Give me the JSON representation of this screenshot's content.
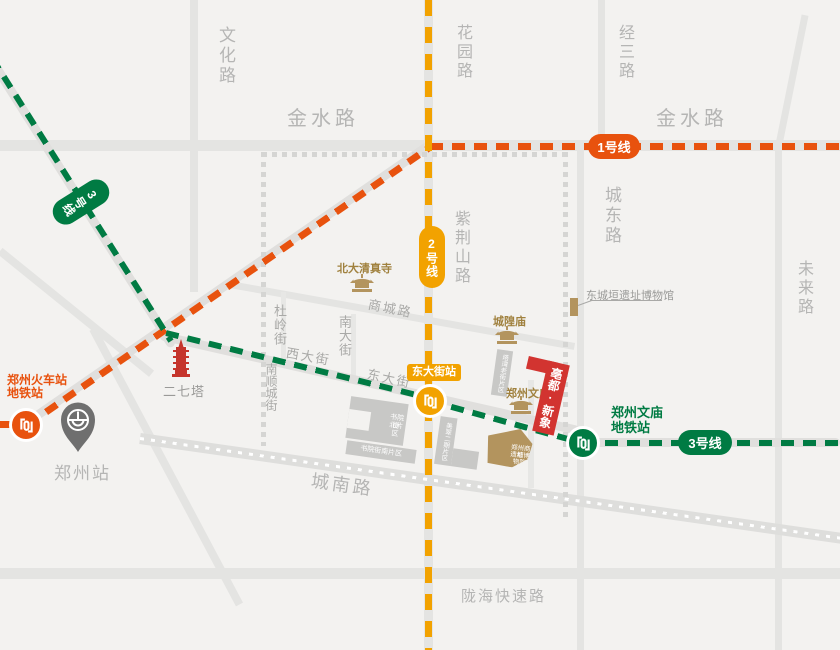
{
  "colors": {
    "line1": "#e8520e",
    "line2": "#f2a200",
    "line3": "#007b43",
    "gold": "#b3945e",
    "goldtext": "#a0813e",
    "red": "#d23430",
    "tower": "#c5352c",
    "pin": "#6f6f6f"
  },
  "roads": {
    "jinshui": "金水路",
    "wenhua": "文化路",
    "huayuan": "花园路",
    "jingsan": "经三路",
    "chengdong": "城东路",
    "weilai": "未来路",
    "zijinshan": "紫荆山路",
    "shangcheng": "商城路",
    "duling": "杜岭街",
    "nandajie": "南大街",
    "xidajie": "西大街",
    "dongdajie": "东大街",
    "nanshuncheng": "南顺城街",
    "chengnan": "城南路",
    "longhai": "陇海快速路"
  },
  "metro": {
    "line1": "1号线",
    "line2": "2号线",
    "line3": "3号线"
  },
  "stations": {
    "railway_metro_line1": "郑州火车站",
    "railway_metro_line2": "地铁站",
    "zhengzhou_station": "郑州站",
    "dongdajie_station": "东大街站",
    "wenmiao_line1": "郑州文庙",
    "wenmiao_line2": "地铁站"
  },
  "landmarks": {
    "erqi_tower": "二七塔",
    "beida_mosque": "北大清真寺",
    "chenghuang_temple": "城隍庙",
    "wenmiao": "郑州文庙",
    "dongchengyuan_museum": "东城垣遗址博物馆",
    "bodu_xinxiang": "亳都·新象",
    "shangdu_museum_line1": "郑州商都",
    "shangdu_museum_line2": "遗址博物院"
  },
  "blocks": {
    "shuyuan_north_line1": "书院街",
    "shuyuan_north_line2": "北片区",
    "shuyuan_south": "书院街南片区",
    "tawan": "塔湾老街片区",
    "meicui": "美翠二期片区"
  }
}
